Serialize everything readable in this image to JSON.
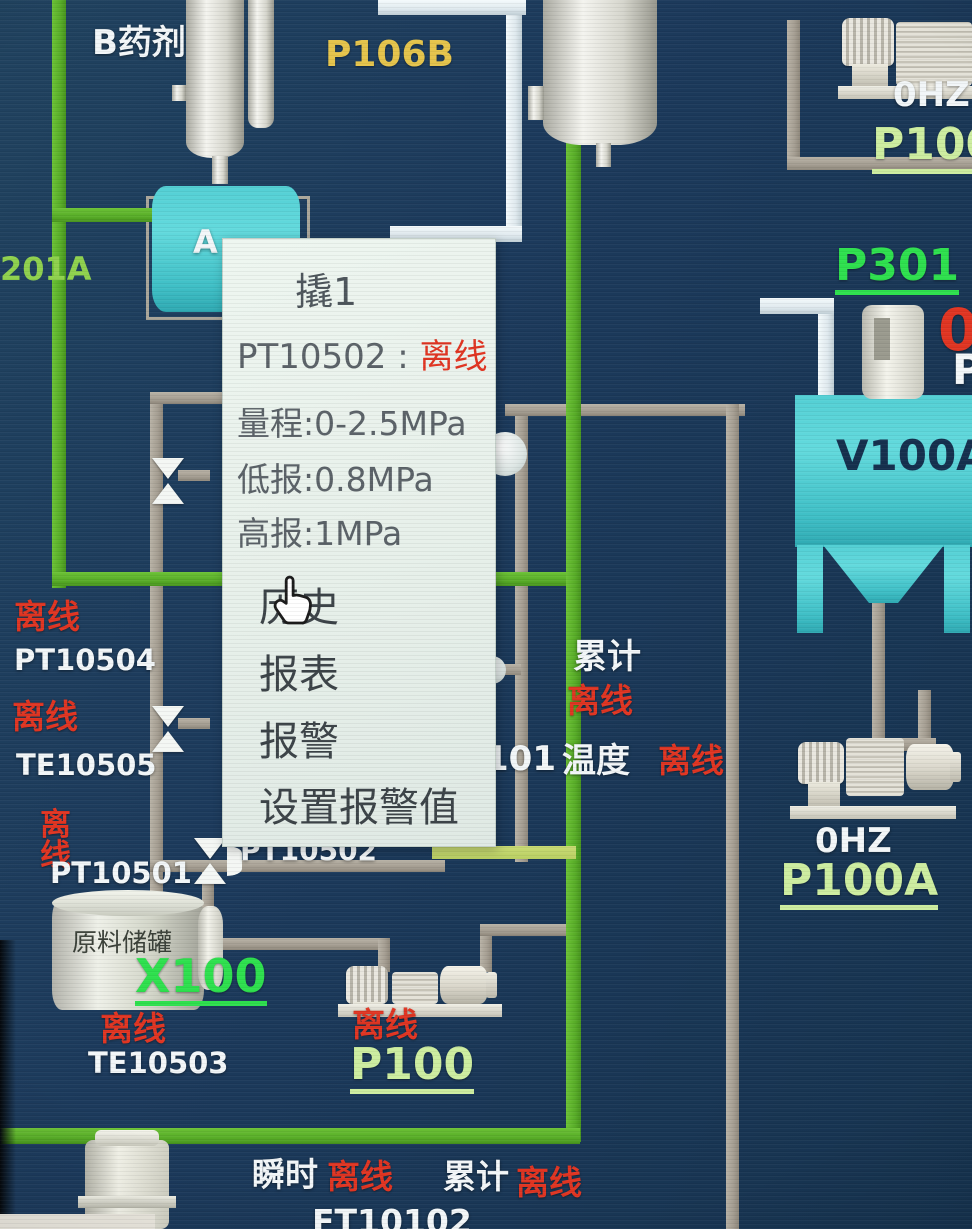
{
  "popup": {
    "title": "撬1",
    "tag": "PT10502",
    "sep": " : ",
    "status": "离线",
    "range": "量程:0-2.5MPa",
    "low": "低报:0.8MPa",
    "high": "高报:1MPa",
    "menu": [
      {
        "label": "历史"
      },
      {
        "label": "报表"
      },
      {
        "label": "报警"
      },
      {
        "label": "设置报警值"
      }
    ]
  },
  "top": {
    "b_agent": "B药剂",
    "p106b": "P106B",
    "a_agent_visible": "A",
    "line_201a": "201A",
    "tr_speed": "0HZ",
    "tr_pump": "P100",
    "p301": "P301",
    "edge_red_partial": "0",
    "edge_white_partial": "P"
  },
  "left_column": {
    "pt10504_status": "离线",
    "pt10504": "PT10504",
    "te10505_status": "离线",
    "te10505": "TE10505",
    "pt10501_status": "离线",
    "pt10501": "PT10501"
  },
  "center": {
    "total_label": "累计",
    "total_status": "离线",
    "temp_prefix": "101",
    "temp_label": "温度",
    "temp_status": "离线",
    "pt10502": "PT10502"
  },
  "right": {
    "v100a": "V100A",
    "p100a_speed": "0HZ",
    "p100a": "P100A"
  },
  "bottom": {
    "raw_tank": "原料储罐",
    "x100": "X100",
    "te10503_status": "离线",
    "te10503": "TE10503",
    "p100_status": "离线",
    "p100": "P100",
    "instant_label": "瞬时",
    "instant_status": "离线",
    "total_label": "累计",
    "total_status": "离线",
    "ft_tag": "FT10102"
  },
  "colors": {
    "background": "#1c3a5c",
    "pipe_green": "#58ad28",
    "pipe_gray": "#a69f93",
    "pipe_white": "#dfe9ee",
    "offline_red": "#e03522",
    "label_white": "#f2f6f8",
    "tag_yellow": "#e5c44c",
    "link_green": "#2ee04e",
    "link_pale_green": "#cdeda0",
    "tank_cyan": "#4ecbd0",
    "popup_bg": "#e9f2ec"
  }
}
